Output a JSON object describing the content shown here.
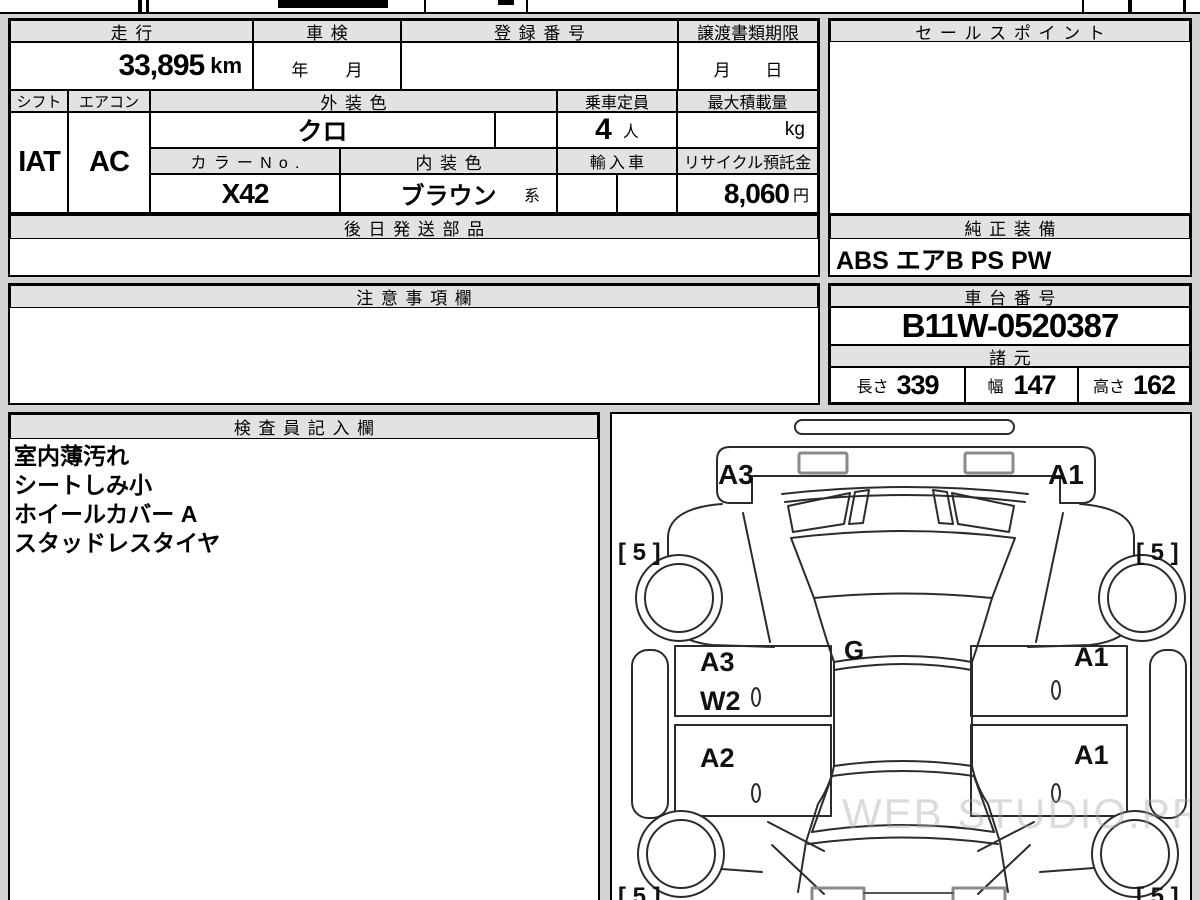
{
  "top_table": {
    "mileage_label": "走行",
    "mileage_value": "33,895",
    "mileage_unit": "km",
    "inspection_label": "車検",
    "inspection_year": "年",
    "inspection_month": "月",
    "registration_label": "登録番号",
    "deadline_label": "譲渡書類期限",
    "deadline_month": "月",
    "deadline_day": "日",
    "shift_label": "シフト",
    "shift_value": "IAT",
    "aircon_label": "エアコン",
    "aircon_value": "AC",
    "exterior_label": "外装色",
    "exterior_value": "クロ",
    "capacity_label": "乗車定員",
    "capacity_value": "4",
    "capacity_unit": "人",
    "maxload_label": "最大積載量",
    "maxload_unit": "kg",
    "colorno_label": "カラーNo.",
    "colorno_value": "X42",
    "interior_label": "内装色",
    "interior_value": "ブラウン",
    "interior_suffix": "系",
    "import_label": "輸入車",
    "recycle_label": "リサイクル預託金",
    "recycle_value": "8,060",
    "recycle_unit": "円"
  },
  "sales_point": {
    "title": "セールスポイント"
  },
  "later_parts": {
    "title": "後日発送部品"
  },
  "equipment": {
    "title": "純正装備",
    "value": "ABS エアB PS PW"
  },
  "cautions": {
    "title": "注意事項欄"
  },
  "chassis": {
    "title": "車台番号",
    "number": "B11W-0520387"
  },
  "specs": {
    "title": "諸元",
    "dims": [
      {
        "label": "長さ",
        "value": "339"
      },
      {
        "label": "幅",
        "value": "147"
      },
      {
        "label": "高さ",
        "value": "162"
      }
    ]
  },
  "inspector": {
    "title": "検査員記入欄",
    "lines": [
      "室内薄汚れ",
      "シートしみ小",
      "ホイールカバー A",
      "スタッドレスタイヤ"
    ]
  },
  "diagram": {
    "rear_left": "A3",
    "rear_right": "A1",
    "roof": "G",
    "door_left_rear": "A3",
    "door_left_window": "W2",
    "door_left_front": "A2",
    "door_right_rear": "A1",
    "door_right_front": "A1",
    "tire_rear_left": "[ 5 ]",
    "tire_rear_right": "[ 5 ]",
    "tire_front_left": "[ 5 ]",
    "tire_front_right": "[ 5 ]",
    "watermark": "WEB STUDIO.PRO"
  }
}
